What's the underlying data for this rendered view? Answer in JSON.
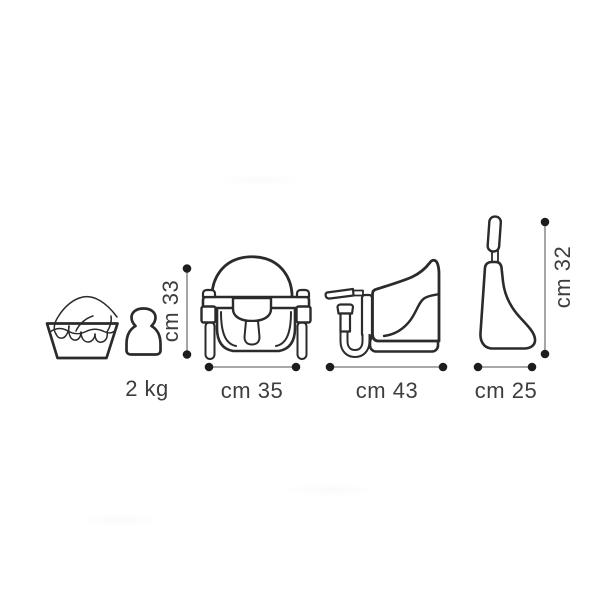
{
  "diagram_labels": {
    "weight_max": "2 kg",
    "front_width": "cm 35",
    "front_height": "cm 33",
    "side_depth": "cm 43",
    "folded_width": "cm 25",
    "folded_height": "cm 32"
  },
  "icons": {
    "hand_wash": "hand-wash-icon",
    "weight": "weight-icon",
    "seat_front": "seat-front-view-icon",
    "seat_side": "seat-side-view-icon",
    "seat_folded": "seat-folded-view-icon"
  },
  "colors": {
    "outline": "#2b2b2d",
    "dimension_line": "#9b9b9b",
    "dimension_dot": "#1d1d1f",
    "text": "#3d3d3f",
    "background": "#ffffff"
  }
}
